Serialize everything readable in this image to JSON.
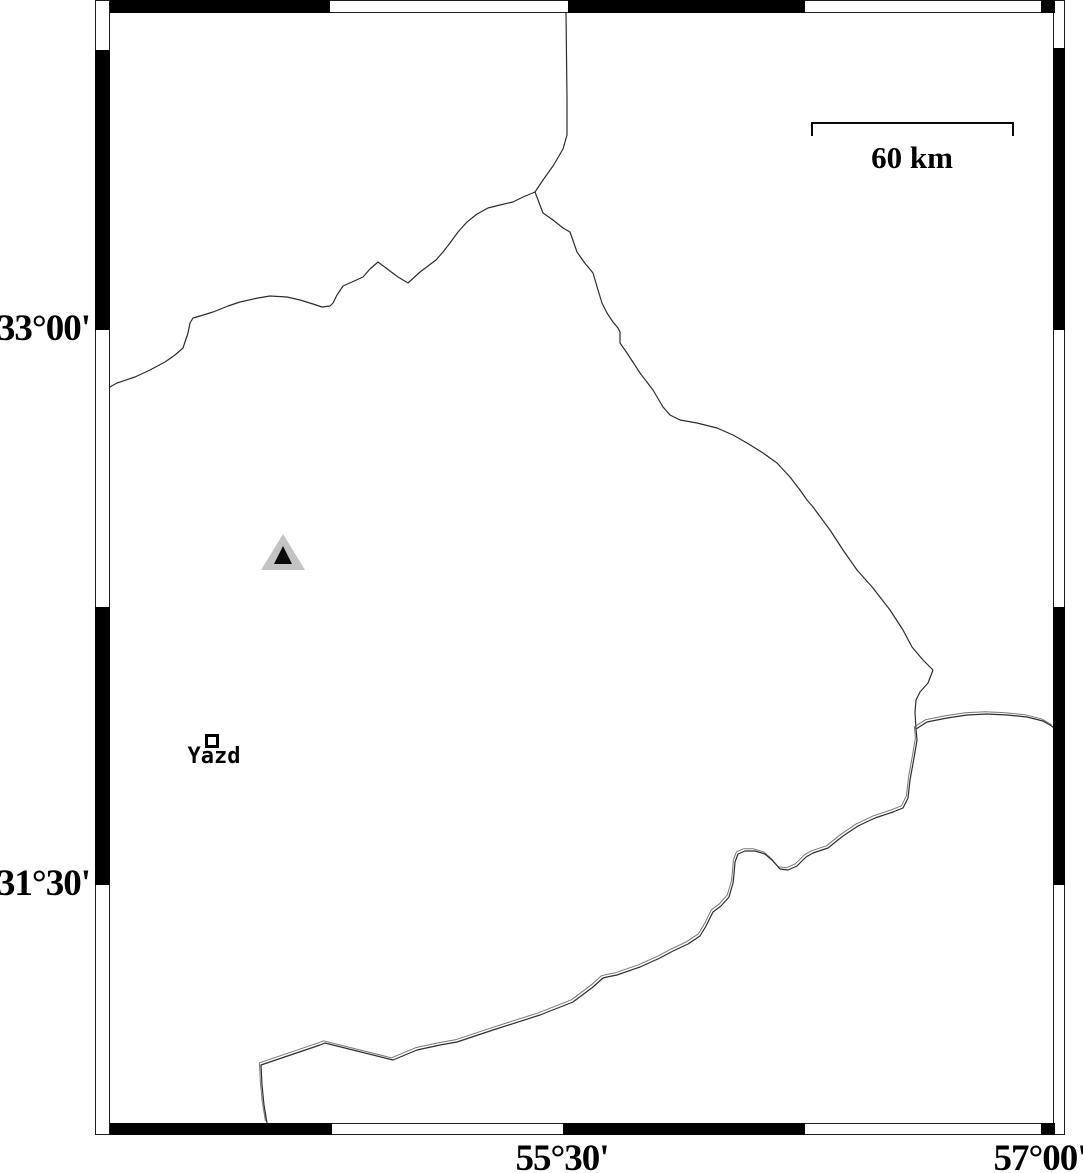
{
  "map": {
    "background": "#ffffff",
    "frame": {
      "outline_color": "#1c1c1c",
      "black": "#000000",
      "outer": {
        "x": 95,
        "y": 0,
        "w": 970,
        "h": 1135
      },
      "left_strip": {
        "x": 95,
        "w": 15
      },
      "right_strip": {
        "x": 1053,
        "w": 12
      },
      "top_strip": {
        "y": 0,
        "h": 13
      },
      "bottom_strip": {
        "y": 1123,
        "h": 12
      },
      "segments": {
        "top": [
          [
            110,
            330
          ],
          [
            568,
            805
          ],
          [
            1041,
            1055
          ]
        ],
        "bottom": [
          [
            110,
            332
          ],
          [
            563,
            805
          ],
          [
            1041,
            1055
          ]
        ],
        "left": [
          [
            50,
            330
          ],
          [
            607,
            885
          ]
        ],
        "right": [
          [
            48,
            330
          ],
          [
            607,
            885
          ]
        ]
      }
    },
    "axis_labels": {
      "left": [
        {
          "text": "33°00'",
          "x": 90,
          "y": 330
        },
        {
          "text": "31°30'",
          "x": 90,
          "y": 885
        }
      ],
      "bottom": [
        {
          "text": "55°30'",
          "x": 562,
          "y": 1137
        },
        {
          "text": "57°00'",
          "x": 1040,
          "y": 1137
        }
      ]
    },
    "scale_bar": {
      "label": "60 km",
      "x1": 812,
      "x2": 1013,
      "y": 123,
      "tick_len": 13,
      "label_x": 912,
      "label_y": 140,
      "color": "#0a0a0a"
    },
    "markers": {
      "triangle": {
        "outer": {
          "points": [
            [
              283,
              534
            ],
            [
              261,
              570
            ],
            [
              305,
              570
            ]
          ],
          "color": "#c3c3c3"
        },
        "inner": {
          "points": [
            [
              283,
              546
            ],
            [
              274,
              564
            ],
            [
              292,
              564
            ]
          ],
          "color": "#0a0a0a"
        }
      },
      "city": {
        "label": "Yazd",
        "x": 212,
        "y": 741,
        "size": 11,
        "border": 3,
        "label_x": 214,
        "label_y": 744,
        "color": "#000000"
      }
    },
    "boundaries": {
      "color": "#2d2d2d",
      "double_offset": [
        -1.6,
        -2.2
      ],
      "north": [
        [
          566,
          13
        ],
        [
          567,
          100
        ],
        [
          567,
          135
        ],
        [
          563,
          149
        ],
        [
          553,
          166
        ],
        [
          543,
          180
        ],
        [
          535,
          192
        ]
      ],
      "west": [
        [
          535,
          192
        ],
        [
          523,
          197
        ],
        [
          513,
          202
        ],
        [
          500,
          205
        ],
        [
          488,
          208
        ],
        [
          477,
          214
        ],
        [
          467,
          222
        ],
        [
          458,
          232
        ],
        [
          450,
          243
        ],
        [
          443,
          252
        ],
        [
          436,
          260
        ],
        [
          428,
          266
        ],
        [
          420,
          272
        ],
        [
          408,
          283
        ],
        [
          398,
          277
        ],
        [
          390,
          271
        ],
        [
          378,
          262
        ],
        [
          370,
          269
        ],
        [
          363,
          277
        ],
        [
          352,
          282
        ],
        [
          343,
          286
        ],
        [
          337,
          295
        ],
        [
          333,
          303
        ],
        [
          330,
          306
        ],
        [
          322,
          307
        ],
        [
          313,
          304
        ],
        [
          300,
          300
        ],
        [
          287,
          297
        ],
        [
          270,
          296
        ],
        [
          258,
          298
        ],
        [
          240,
          302
        ],
        [
          228,
          306
        ],
        [
          213,
          312
        ],
        [
          200,
          316
        ],
        [
          193,
          318
        ],
        [
          190,
          323
        ],
        [
          188,
          333
        ],
        [
          183,
          348
        ],
        [
          175,
          355
        ],
        [
          165,
          362
        ],
        [
          150,
          370
        ],
        [
          135,
          377
        ],
        [
          117,
          383
        ],
        [
          108,
          388
        ]
      ],
      "east": [
        [
          535,
          192
        ],
        [
          543,
          213
        ],
        [
          553,
          220
        ],
        [
          563,
          228
        ],
        [
          570,
          232
        ],
        [
          577,
          252
        ],
        [
          584,
          262
        ],
        [
          593,
          273
        ],
        [
          598,
          290
        ],
        [
          602,
          303
        ],
        [
          607,
          313
        ],
        [
          613,
          322
        ],
        [
          618,
          328
        ],
        [
          620,
          332
        ],
        [
          620,
          343
        ],
        [
          627,
          353
        ],
        [
          640,
          373
        ],
        [
          653,
          390
        ],
        [
          663,
          407
        ],
        [
          670,
          415
        ],
        [
          680,
          420
        ],
        [
          697,
          423
        ],
        [
          717,
          428
        ],
        [
          733,
          435
        ],
        [
          747,
          443
        ],
        [
          763,
          453
        ],
        [
          777,
          463
        ],
        [
          790,
          477
        ],
        [
          800,
          490
        ],
        [
          807,
          500
        ],
        [
          813,
          507
        ],
        [
          830,
          530
        ],
        [
          843,
          550
        ],
        [
          857,
          570
        ],
        [
          873,
          588
        ],
        [
          890,
          610
        ],
        [
          903,
          630
        ],
        [
          912,
          647
        ],
        [
          923,
          660
        ],
        [
          933,
          670
        ],
        [
          928,
          683
        ],
        [
          920,
          692
        ],
        [
          916,
          700
        ],
        [
          915,
          712
        ],
        [
          916,
          729
        ]
      ],
      "south_double": [
        [
          1053,
          727
        ],
        [
          1050,
          725
        ],
        [
          1043,
          721
        ],
        [
          1027,
          717
        ],
        [
          1007,
          715
        ],
        [
          987,
          714
        ],
        [
          967,
          715
        ],
        [
          947,
          718
        ],
        [
          927,
          722
        ],
        [
          916,
          729
        ],
        [
          917,
          740
        ],
        [
          914,
          758
        ],
        [
          910,
          780
        ],
        [
          908,
          798
        ],
        [
          903,
          808
        ],
        [
          893,
          812
        ],
        [
          875,
          818
        ],
        [
          858,
          826
        ],
        [
          843,
          836
        ],
        [
          828,
          848
        ],
        [
          813,
          853
        ],
        [
          806,
          857
        ],
        [
          797,
          866
        ],
        [
          788,
          870
        ],
        [
          780,
          869
        ],
        [
          772,
          860
        ],
        [
          765,
          854
        ],
        [
          755,
          851
        ],
        [
          745,
          851
        ],
        [
          738,
          854
        ],
        [
          735,
          862
        ],
        [
          734,
          874
        ],
        [
          733,
          883
        ],
        [
          729,
          897
        ],
        [
          721,
          906
        ],
        [
          713,
          912
        ],
        [
          706,
          926
        ],
        [
          700,
          936
        ],
        [
          688,
          944
        ],
        [
          673,
          951
        ],
        [
          660,
          958
        ],
        [
          640,
          967
        ],
        [
          617,
          975
        ],
        [
          607,
          977
        ],
        [
          603,
          978
        ],
        [
          593,
          987
        ],
        [
          573,
          1002
        ],
        [
          540,
          1015
        ],
        [
          493,
          1030
        ],
        [
          457,
          1042
        ],
        [
          440,
          1045
        ],
        [
          417,
          1050
        ],
        [
          393,
          1060
        ],
        [
          325,
          1043
        ],
        [
          320,
          1045
        ],
        [
          261,
          1065
        ],
        [
          262,
          1085
        ],
        [
          264,
          1105
        ],
        [
          267,
          1123
        ]
      ]
    }
  }
}
